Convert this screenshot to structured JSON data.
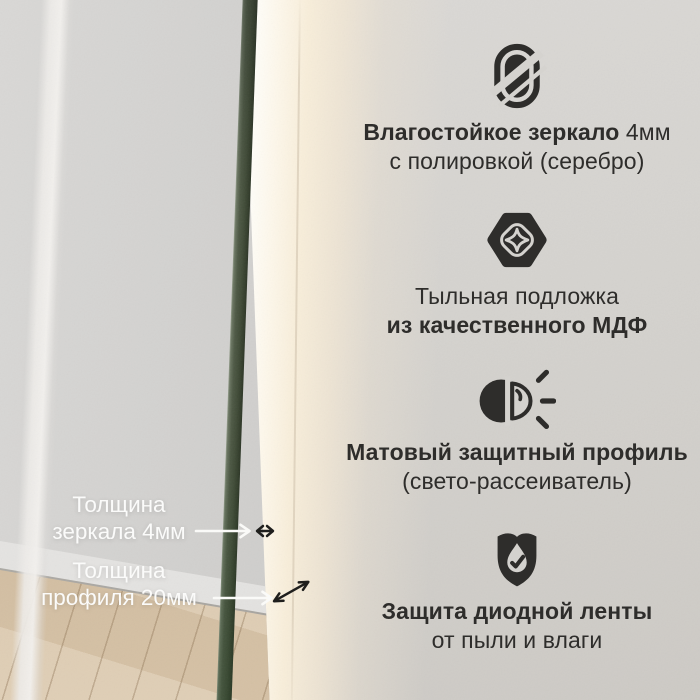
{
  "features": [
    {
      "name": "moisture-resistant-mirror",
      "icon": "mirror-icon",
      "line1_bold": "Влагостойкое зеркало",
      "line1_rest": " 4мм",
      "line2": "с полировкой (серебро)"
    },
    {
      "name": "mdf-backing",
      "icon": "mdf-backing-icon",
      "line1": "Тыльная подложка",
      "line2_bold": "из качественного МДФ"
    },
    {
      "name": "matte-protective-profile",
      "icon": "light-diffuser-icon",
      "line1_bold": "Матовый защитный профиль",
      "line2": "(свето-рассеиватель)"
    },
    {
      "name": "led-strip-protection",
      "icon": "shield-check-icon",
      "line1_bold": "Защита диодной ленты",
      "line2": "от пыли и влаги"
    }
  ],
  "measurements": [
    {
      "name": "mirror-thickness",
      "line1": "Толщина",
      "line2": "зеркала 4мм"
    },
    {
      "name": "profile-thickness",
      "line1": "Толщина",
      "line2": "профиля 20мм"
    }
  ],
  "colors": {
    "text_dark": "#2e2d2b",
    "text_light": "#fbfbfa",
    "edge_green": "#43503a",
    "led_glow": "#fdf6e8",
    "wall": "#d4d2ce"
  }
}
